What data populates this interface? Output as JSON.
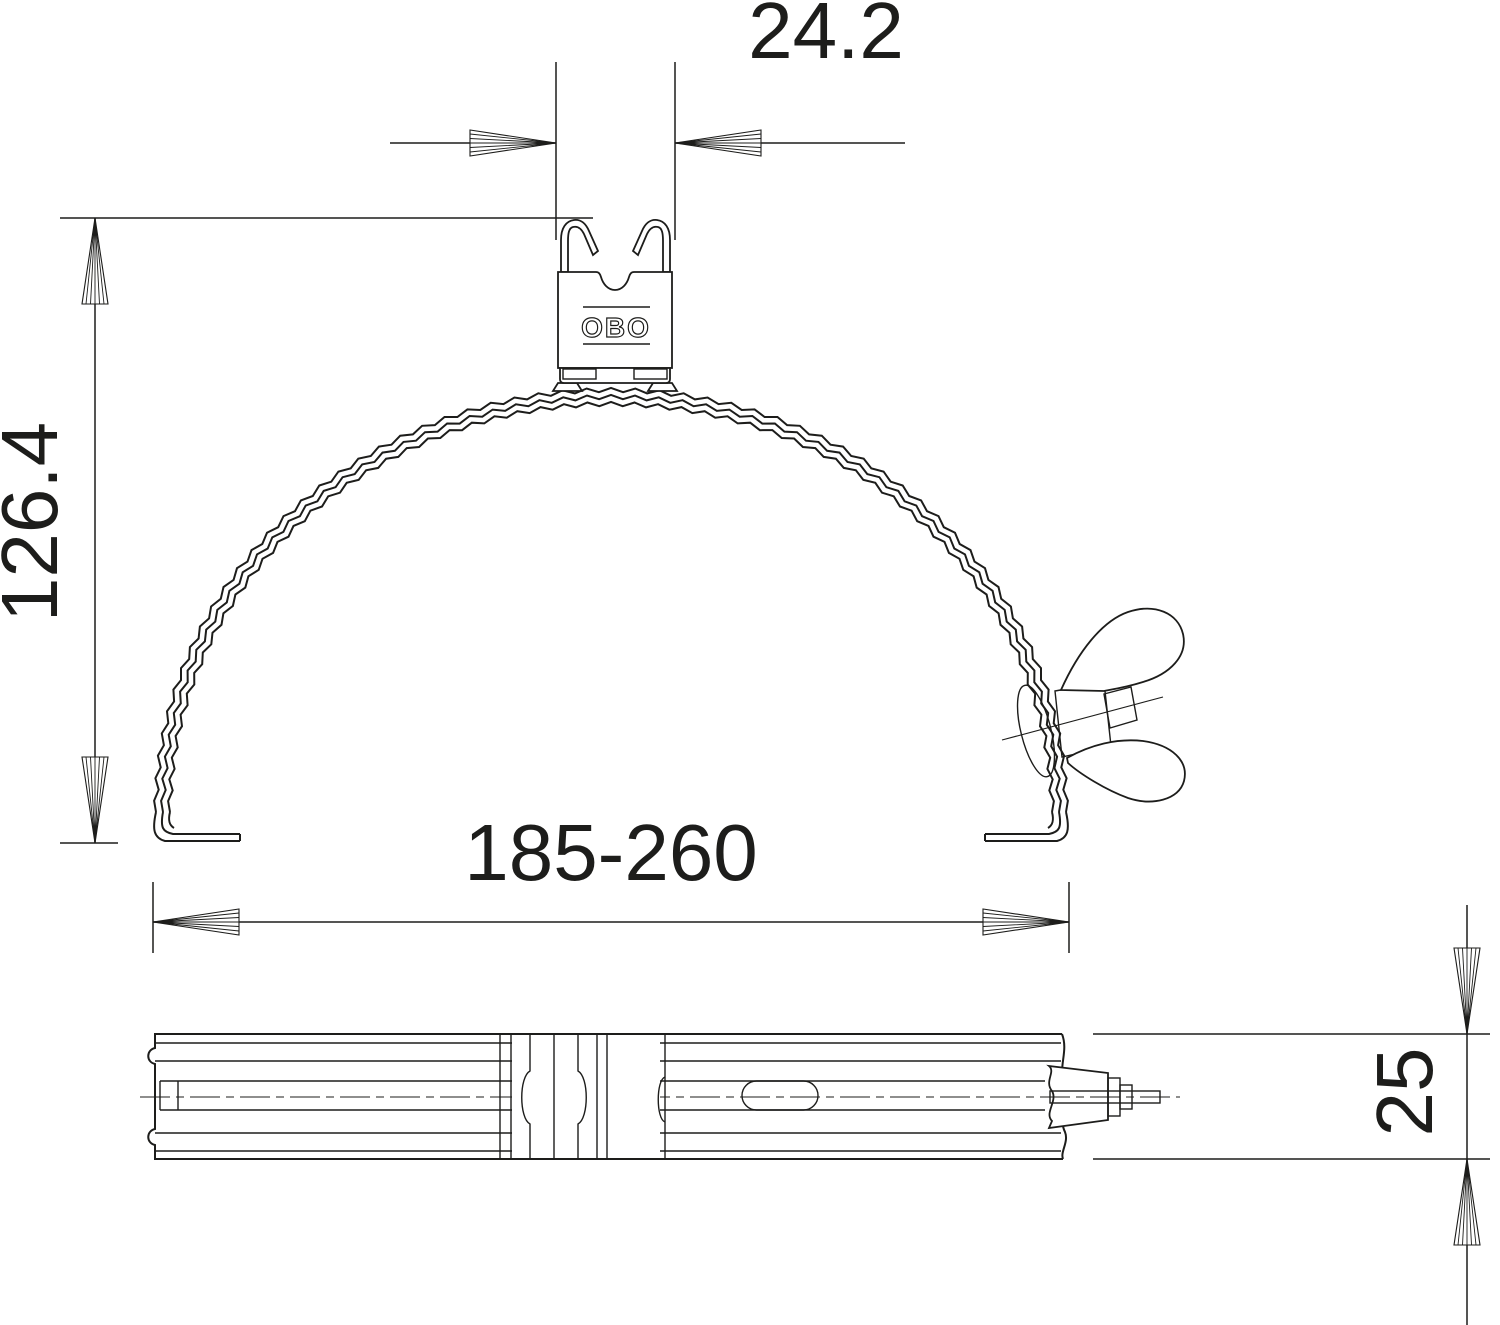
{
  "drawing": {
    "background_color": "#ffffff",
    "line_color": "#1d1d1b",
    "logo_text": "OBO",
    "dimensions": {
      "clip_width": "24.2",
      "overall_height": "126.4",
      "clamping_range": "185-260",
      "band_width": "25"
    }
  }
}
